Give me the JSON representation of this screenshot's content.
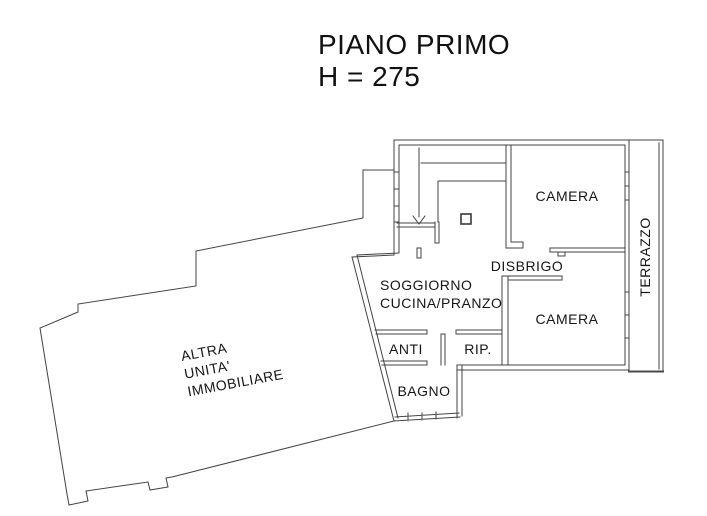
{
  "title": {
    "line1": "PIANO PRIMO",
    "line2": "H = 275"
  },
  "rooms": {
    "camera_top": "CAMERA",
    "disbrigo": "DISBRIGO",
    "camera_bottom": "CAMERA",
    "soggiorno_line1": "SOGGIORNO",
    "soggiorno_line2": "CUCINA/PRANZO",
    "anti": "ANTI",
    "rip": "RIP.",
    "bagno": "BAGNO",
    "terrazzo": "TERRAZZO",
    "altra_unita_line1": "ALTRA",
    "altra_unita_line2": "UNITA'",
    "altra_unita_line3": "IMMOBILIARE"
  },
  "colors": {
    "line": "#434343",
    "text": "#161616",
    "background": "#ffffff"
  }
}
